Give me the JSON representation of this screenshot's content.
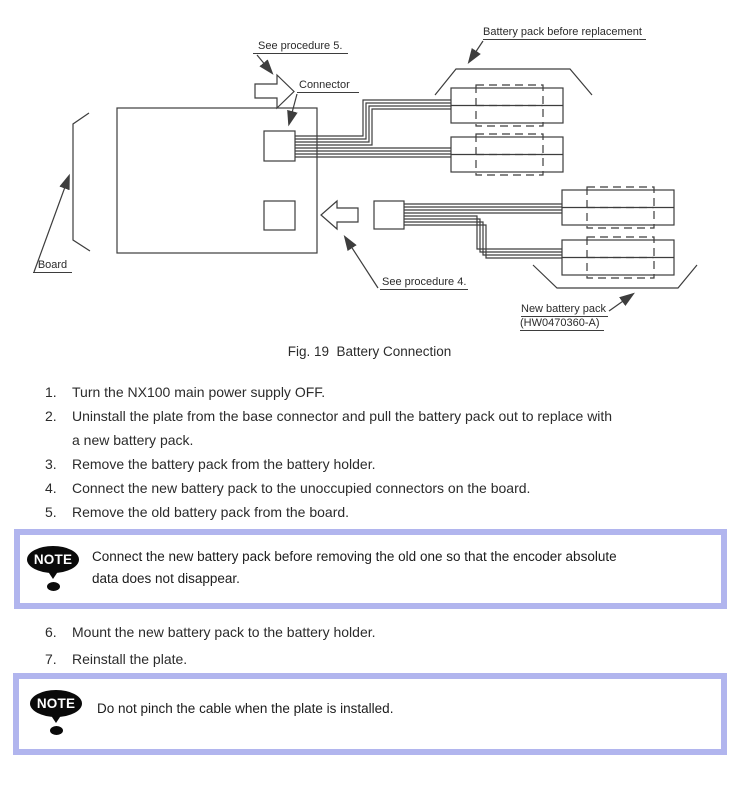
{
  "figure": {
    "labels": {
      "see_procedure_5": "See procedure 5.",
      "connector": "Connector",
      "battery_before": "Battery pack before replacement",
      "board": "Board",
      "see_procedure_4": "See procedure 4.",
      "new_battery_pack": "New battery pack",
      "new_battery_code": "(HW0470360-A)"
    },
    "caption": "Fig. 19  Battery Connection"
  },
  "steps_1_5": [
    {
      "num": "1.",
      "lines": [
        "Turn the NX100 main power supply OFF."
      ]
    },
    {
      "num": "2.",
      "lines": [
        "Uninstall the plate from the base connector and pull the battery pack out to replace with",
        "a new battery pack."
      ]
    },
    {
      "num": "3.",
      "lines": [
        "Remove the battery pack from the battery holder."
      ]
    },
    {
      "num": "4.",
      "lines": [
        "Connect the new battery pack to the unoccupied connectors on the board."
      ]
    },
    {
      "num": "5.",
      "lines": [
        "Remove the old battery pack from the board."
      ]
    }
  ],
  "note_1": {
    "icon_label": "NOTE",
    "lines": [
      "Connect the new battery pack before removing the old one so that the encoder absolute",
      "data does not disappear."
    ]
  },
  "steps_6_7": [
    {
      "num": "6.",
      "lines": [
        "Mount the new battery pack to the battery holder."
      ]
    },
    {
      "num": "7.",
      "lines": [
        "Reinstall the plate."
      ]
    }
  ],
  "note_2": {
    "icon_label": "NOTE",
    "lines": [
      "Do not pinch the cable when the plate is installed."
    ]
  },
  "colors": {
    "note_border": "#b1b5ee",
    "diagram_line": "#3d3d3d",
    "text": "#2b2b2b"
  }
}
